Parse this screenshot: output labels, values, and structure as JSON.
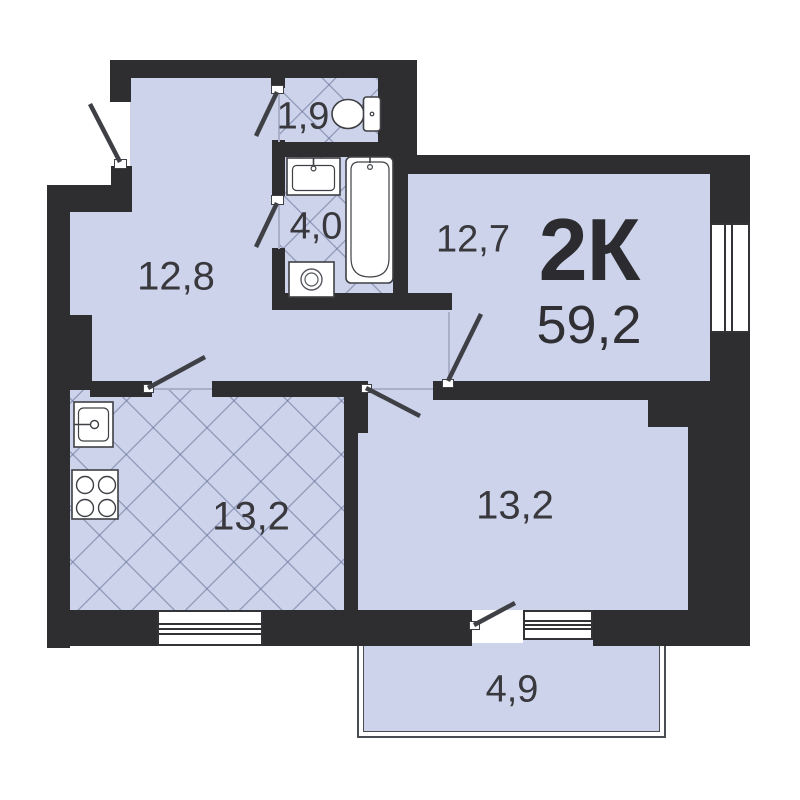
{
  "floorplan": {
    "type_label": "2К",
    "total_area": "59,2",
    "rooms": [
      {
        "name": "toilet",
        "area": "1,9"
      },
      {
        "name": "bathroom",
        "area": "4,0"
      },
      {
        "name": "hallway",
        "area": "12,8"
      },
      {
        "name": "room-1",
        "area": "12,7"
      },
      {
        "name": "kitchen",
        "area": "13,2"
      },
      {
        "name": "room-2",
        "area": "13,2"
      },
      {
        "name": "balcony",
        "area": "4,9"
      }
    ],
    "fixtures": [
      "toilet",
      "wash-basin",
      "bathtub",
      "washing-machine",
      "kitchen-sink",
      "stove-4-burner"
    ],
    "colors": {
      "wall": "#2e2e31",
      "room_fill": "#ccd3ea",
      "hatch_line": "#687398",
      "fixture_outline": "#3e4045",
      "text": "#38383d",
      "background": "#ffffff"
    }
  }
}
